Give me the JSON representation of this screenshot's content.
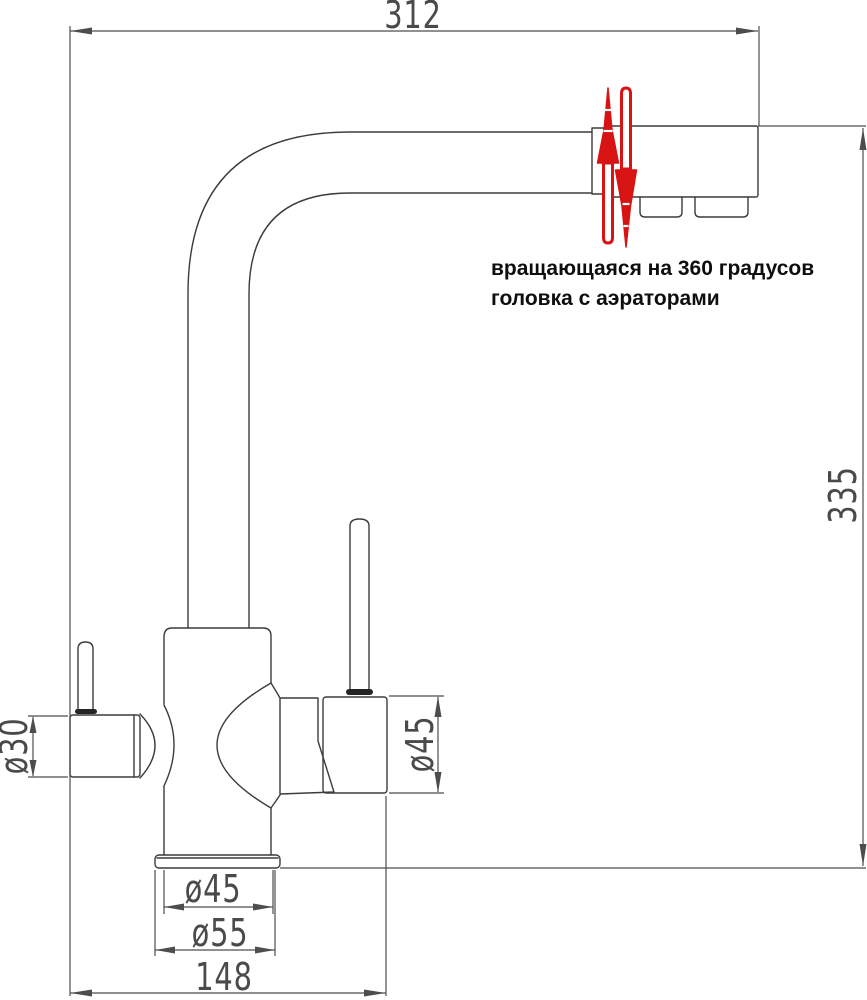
{
  "colors": {
    "background": "#ffffff",
    "line": "#3c3c3c",
    "dimension_line": "#4d4d4d",
    "dimension_text": "#4a4a4a",
    "annotation_text": "#0e0e0e",
    "accent_red": "#d81313"
  },
  "dimensions": {
    "top_width": "312",
    "overall_height": "335",
    "left_valve_diameter": "ø30",
    "right_valve_diameter": "ø45",
    "base_neck_diameter": "ø45",
    "base_flange_diameter": "ø55",
    "body_length": "148"
  },
  "annotation": {
    "line1": "вращающаяся на 360 градусов",
    "line2": "головка с аэраторами"
  }
}
